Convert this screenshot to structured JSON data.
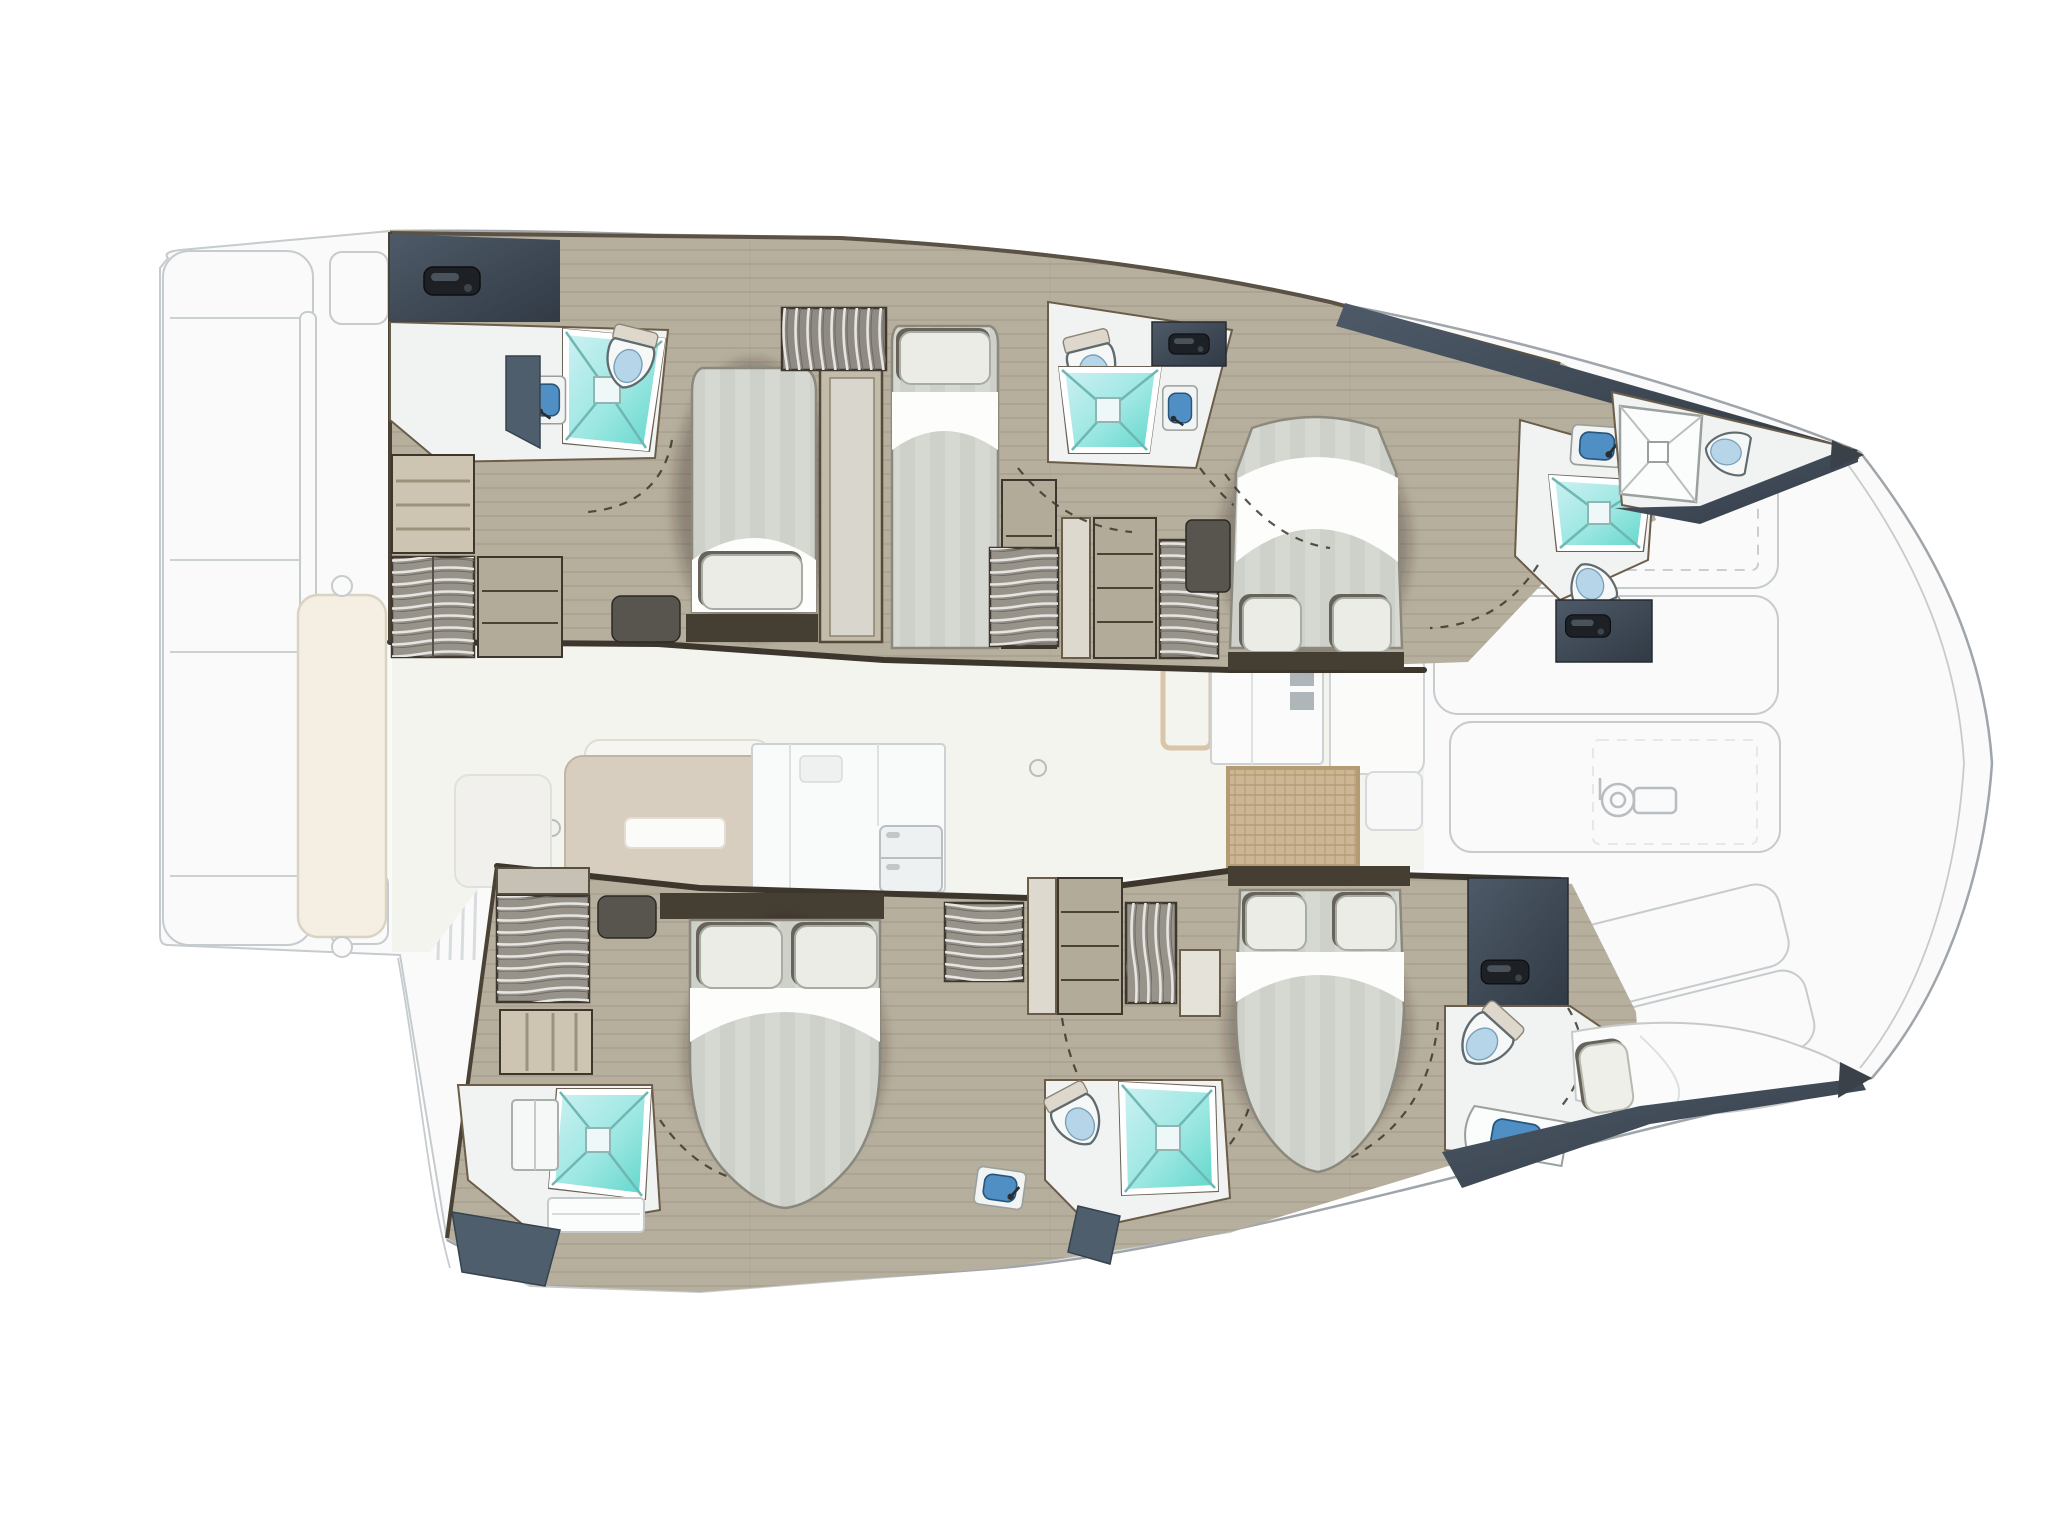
{
  "page": {
    "title": "Catamaran interior layout plan — overhead deck view, bow to the right",
    "background": "#ffffff",
    "text_on_image": "none"
  },
  "colors": {
    "wood": "#b6af9d",
    "wood-line": "#8d8268",
    "wall-dark": "#3d362c",
    "trim": "#6b5d49",
    "slate-1": "#4a5664",
    "slate-2": "#333c47",
    "navy": "#4e5e6c",
    "handle": "#1d2126",
    "bath-floor": "#f1f3f2",
    "teal-1": "#c9f0f2",
    "teal-2": "#63d8ce",
    "teal-line": "#6fb7b2",
    "mattress": "#d6d9d2",
    "mattress-stripe": "#cdd1c9",
    "linen": "#fdfdfc",
    "pillow": "#eaece5",
    "pillow-shadow": "#67635a",
    "headboard": "#453e33",
    "locker-base": "#97938a",
    "locker-rib": "#e6e5e1",
    "shelf": "#b3ab99",
    "step": "#cdc5b2",
    "dark-furniture": "#57554e",
    "sink-blue": "#4f8fc4",
    "toilet-blue": "#b7d5e8",
    "ghost-fill": "#f9faf9",
    "ghost-line": "#c6cbce",
    "ghost-strong": "#9fa5aa",
    "salon-floor": "#f4f4ef",
    "sofa": "#d7cec0",
    "sofa-line": "#c0b4a2",
    "bench": "#f4efe2",
    "rattan": "#cdb693",
    "rattan-line": "#a8906b"
  },
  "vessel": {
    "type": "sailing catamaran accommodation plan",
    "view": "top-down, stern at left, bow at right",
    "summary": "4 guest cabins, 4 en-suite heads with showers, 2 bow compartments, ghosted salon/galley and decks",
    "hulls": [
      {
        "name": "port hull (top)",
        "rooms": [
          {
            "name": "aft head",
            "fixtures": [
              "shower tray",
              "toilet",
              "washbasin",
              "companionway door"
            ]
          },
          {
            "name": "aft double cabin",
            "fixtures": [
              "double berth",
              "pillow",
              "hanging locker",
              "entry steps",
              "shelf unit",
              "nightstand"
            ]
          },
          {
            "name": "mid single berth",
            "fixtures": [
              "single berth",
              "pillow",
              "wardrobe"
            ]
          },
          {
            "name": "mid head",
            "fixtures": [
              "shower tray",
              "toilet",
              "washbasin",
              "locker with handle"
            ]
          },
          {
            "name": "midship wardrobes",
            "fixtures": [
              "hanging locker",
              "shelf column",
              "hanging locker"
            ]
          },
          {
            "name": "forward double cabin",
            "fixtures": [
              "island double berth",
              "two pillows",
              "vanity seat"
            ]
          },
          {
            "name": "forward head",
            "fixtures": [
              "washbasin",
              "shower tray",
              "toilet",
              "slate door"
            ]
          },
          {
            "name": "bow compartment",
            "fixtures": [
              "white shower tray",
              "toilet"
            ]
          }
        ]
      },
      {
        "name": "starboard hull (bottom)",
        "rooms": [
          {
            "name": "aft head",
            "fixtures": [
              "shower tray",
              "vanity cabinet",
              "steps",
              "navy bulkhead"
            ]
          },
          {
            "name": "aft double cabin",
            "fixtures": [
              "island double berth",
              "two pillows",
              "nightstand",
              "hanging locker",
              "shelf",
              "entry steps",
              "washbasin"
            ]
          },
          {
            "name": "midship wardrobes",
            "fixtures": [
              "hanging locker",
              "door column",
              "shelf column",
              "hanging locker"
            ]
          },
          {
            "name": "mid head",
            "fixtures": [
              "toilet",
              "shower tray",
              "washbasin"
            ]
          },
          {
            "name": "forward double cabin",
            "fixtures": [
              "island double berth",
              "two pillows",
              "wardrobe"
            ]
          },
          {
            "name": "forward head",
            "fixtures": [
              "slate door",
              "toilet",
              "washbasin"
            ]
          },
          {
            "name": "bow berth",
            "fixtures": [
              "single berth cushion",
              "pillow"
            ]
          }
        ]
      }
    ],
    "salon": {
      "name": "salon and galley (ghosted)",
      "fixtures": [
        "L-settee with table slot",
        "chaise",
        "galley counter",
        "refrigerator",
        "chart table",
        "nav console",
        "nav settee",
        "rattan floor mat",
        "two table posts",
        "sliding door"
      ]
    },
    "exterior": {
      "aft": [
        "swim platform with panels",
        "transom bench",
        "cockpit slat benches",
        "transom steps"
      ],
      "foredeck": [
        "sun lounge cushions",
        "dashed locker hatches",
        "windlass",
        "bow sprit rigging lines"
      ],
      "bow_tips": 2
    }
  }
}
